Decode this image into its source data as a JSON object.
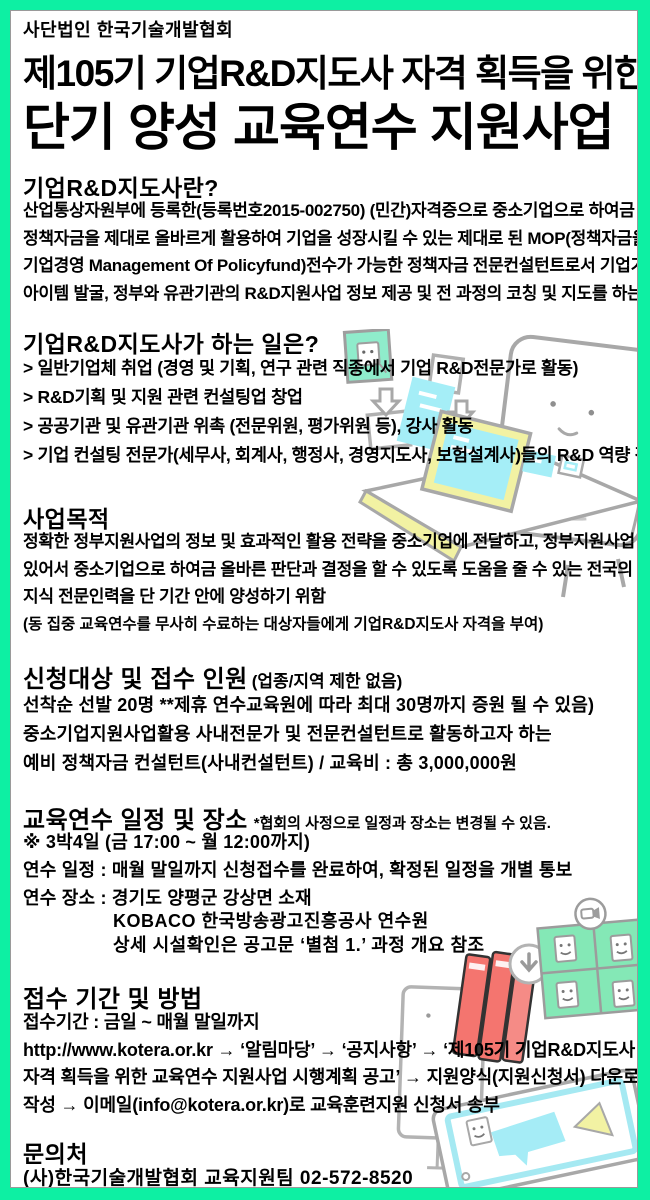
{
  "frame": {
    "border_color": "#0df0a3"
  },
  "header": {
    "org": "사단법인 한국기술개발협회",
    "title_line1": "제105기 기업R&D지도사 자격 획득을 위한",
    "title_line2": "단기 양성 교육연수 지원사업"
  },
  "sections": {
    "about": {
      "heading": "기업R&D지도사란?",
      "lines": [
        "산업통상자원부에 등록한(등록번호2015-002750) (민간)자격증으로 중소기업으로 하여금",
        "정책자금을 제대로 올바르게 활용하여 기업을 성장시킬 수 있는 제대로 된 MOP(정책자금을 활용한",
        "기업경영 Management Of Policyfund)전수가 가능한 정책자금 전문컨설턴트로서 기업기술개발",
        "아이템 발굴, 정부와 유관기관의 R&D지원사업 정보 제공 및 전 과정의 코칭 및 지도를 하는 전문직임"
      ]
    },
    "roles": {
      "heading": "기업R&D지도사가 하는 일은?",
      "items": [
        "> 일반기업체 취업 (경영 및 기획, 연구 관련 직종에서 기업 R&D전문가로 활동)",
        "> R&D기획 및 지원 관련 컨설팅업 창업",
        "> 공공기관 및 유관기관 위촉 (전문위원, 평가위원 등), 강사 활동",
        "> 기업 컨설팅 전문가(세무사, 회계사, 행정사, 경영지도사, 보험설계사)들의 R&D 역량 강화"
      ]
    },
    "purpose": {
      "heading": "사업목적",
      "lines": [
        "정확한 정부지원사업의 정보 및 효과적인 활용 전략을 중소기업에 전달하고, 정부지원사업 활용에",
        "있어서 중소기업으로 하여금 올바른 판단과 결정을 할 수 있도록 도움을 줄 수 있는 전국의 정책자금",
        "지식 전문인력을 단 기간 안에 양성하기 위함"
      ],
      "note": "(동 집중 교육연수를 무사히 수료하는 대상자들에게 기업R&D지도사 자격을 부여)"
    },
    "target": {
      "heading": "신청대상 및 접수 인원",
      "heading_note": "(업종/지역 제한 없음)",
      "lines": [
        "선착순 선발 20명 **제휴 연수교육원에 따라 최대 30명까지 증원 될 수 있음)",
        "중소기업지원사업활용 사내전문가 및 전문컨설턴트로 활동하고자 하는",
        "예비 정책자금 컨설턴트(사내컨설턴트) / 교육비 : 총 3,000,000원"
      ]
    },
    "schedule": {
      "heading": "교육연수 일정 및 장소",
      "heading_note": "*협회의 사정으로 일정과 장소는 변경될 수 있음.",
      "lines": [
        "※ 3박4일 (금 17:00 ~ 월 12:00까지)",
        "연수 일정 : 매월 말일까지 신청접수를 완료하여, 확정된 일정을 개별 통보",
        "연수 장소 : 경기도 양평군 강상면 소재"
      ],
      "sub_lines": [
        "KOBACO 한국방송광고진흥공사 연수원",
        "상세 시설확인은 공고문 ‘별첨 1.’ 과정 개요 참조"
      ]
    },
    "apply": {
      "heading": "접수 기간 및 방법",
      "lines": [
        "접수기간 : 금일 ~ 매월 말일까지",
        "http://www.kotera.or.kr → ‘알림마당’ → ‘공지사항’ → ‘제105기 기업R&D지도사",
        "자격 획득을 위한 교육연수 지원사업 시행계획 공고’ → 지원양식(지원신청서) 다운로드 후",
        "작성 → 이메일(info@kotera.or.kr)로 교육훈련지원 신청서 송부"
      ]
    },
    "contact": {
      "heading": "문의처",
      "line": "(사)한국기술개발협회 교육지원팀 02-572-8520"
    }
  },
  "illustrations": {
    "desk": "monitor-character-with-laptop-and-cards-illustration",
    "bottom": "books-download-video-grid-tablet-illustration"
  }
}
